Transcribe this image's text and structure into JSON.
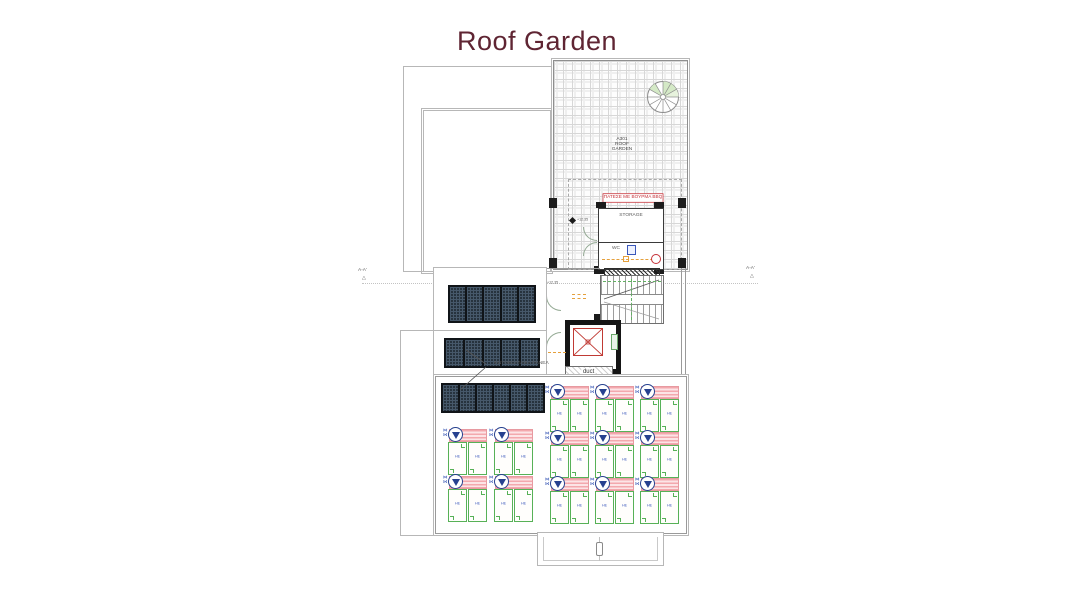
{
  "title": "Roof Garden",
  "plan": {
    "room_lines": [
      "A301",
      "ROOF",
      "GARDEN"
    ],
    "bbq_note": "ΠΑΤΕΣΕ ΜΕ ΒΟΥΡΜΑ BBQ",
    "storage_label": "STORAGE",
    "wc_label": "WC",
    "duct_label": "duct",
    "pv_label": "ΦΩΤΟΒΟΛΤΑΙΚΑ ΠΑΝΕΛ",
    "section_marker": "A-A'",
    "elevation": "+12.35",
    "lounger_label": "HE"
  },
  "icons": {
    "bowtie": "⋈",
    "section_triangle": "△"
  },
  "colors": {
    "title": "#5f2533",
    "outline": "#b7b7b7",
    "wall": "#3a3a3a",
    "red_accent": "#c6333a",
    "green_accent": "#57b157",
    "pink_shade": "#f3a8ad",
    "navy": "#26418f",
    "panel_dark": "#27333e"
  },
  "solar": {
    "groups": [
      {
        "panels": 5
      },
      {
        "panels": 5
      },
      {
        "panels": 6
      }
    ]
  },
  "sunbeds": {
    "left_grid": {
      "cols": 2,
      "rows": 2
    },
    "right_grid": {
      "cols": 3,
      "rows": 3
    }
  }
}
